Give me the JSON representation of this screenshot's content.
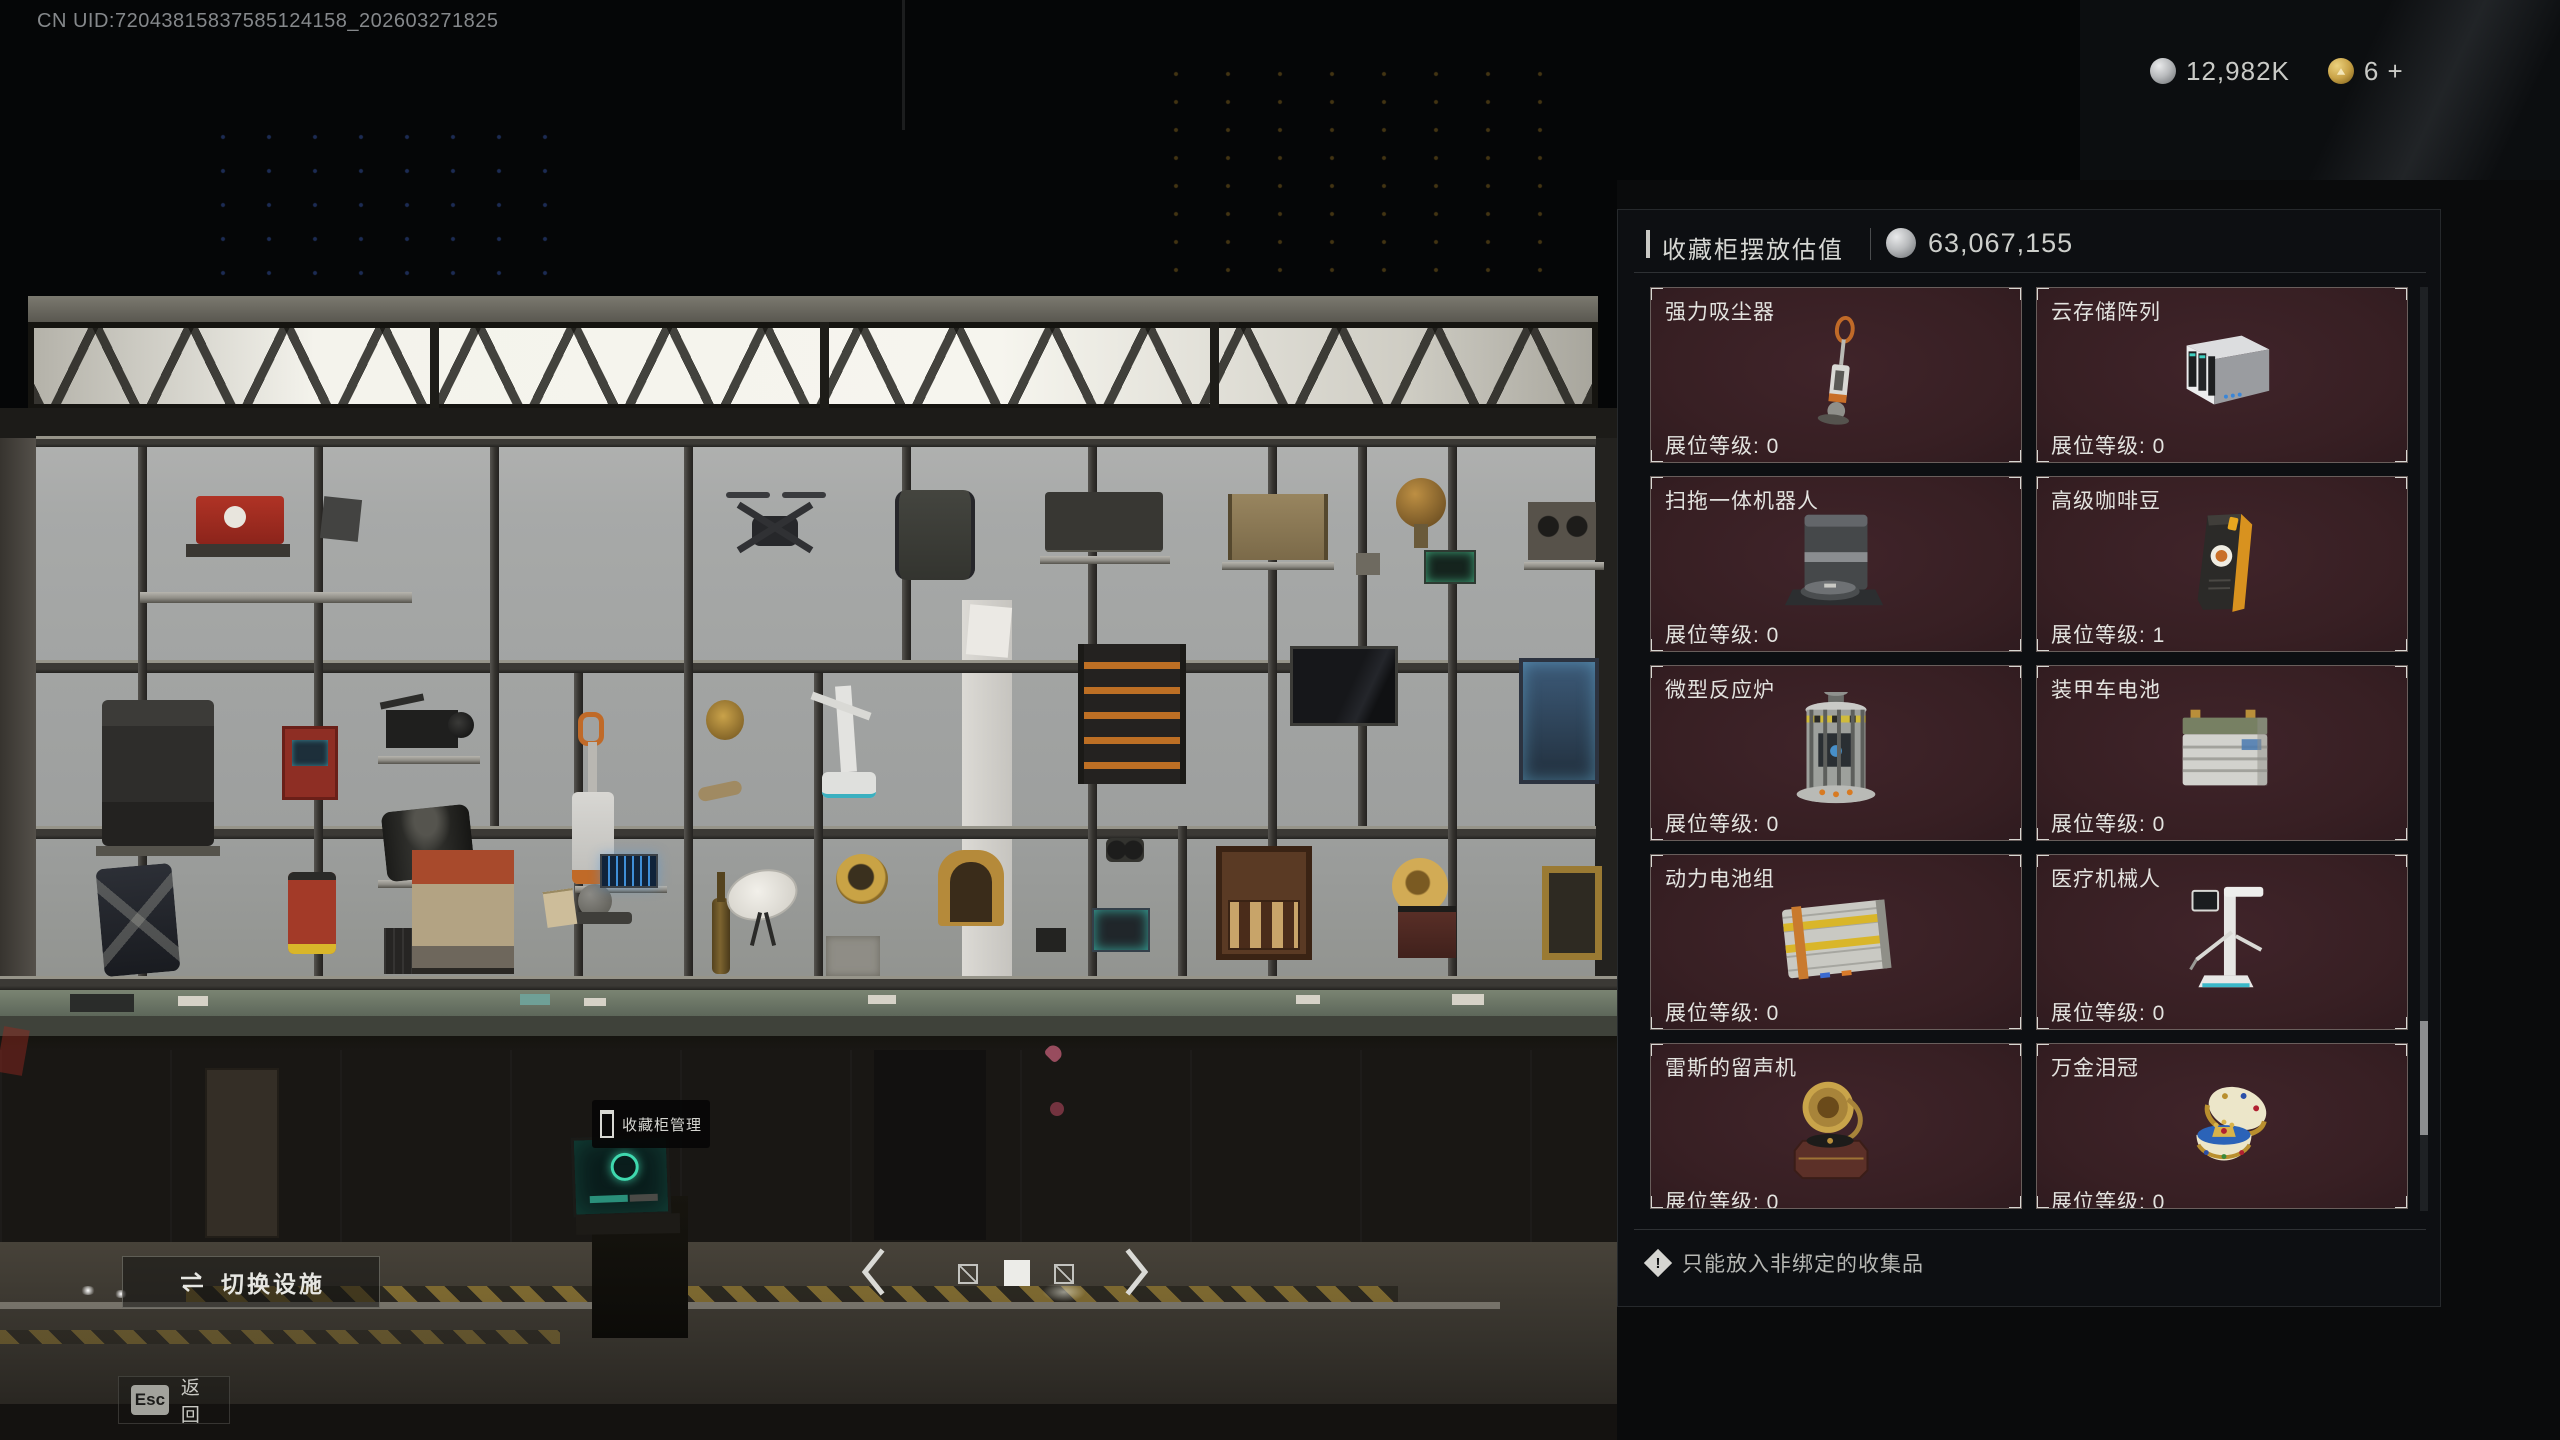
{
  "top_bar": {
    "uid": "CN UID:72043815837585124158_202603271825",
    "currencies": [
      {
        "icon": "silver-coin",
        "value": "12,982K"
      },
      {
        "icon": "gold-coin",
        "value": "6 +"
      }
    ]
  },
  "panel": {
    "title": "收藏柜摆放估值",
    "value_icon": "silver-coin",
    "value": "63,067,155",
    "level_label": "展位等级: ",
    "items": [
      {
        "name": "强力吸尘器",
        "level": "0",
        "art": "vacuum"
      },
      {
        "name": "云存储阵列",
        "level": "0",
        "art": "nas"
      },
      {
        "name": "扫拖一体机器人",
        "level": "0",
        "art": "robot-mop"
      },
      {
        "name": "高级咖啡豆",
        "level": "1",
        "art": "coffee-bag"
      },
      {
        "name": "微型反应炉",
        "level": "0",
        "art": "micro-reactor"
      },
      {
        "name": "装甲车电池",
        "level": "0",
        "art": "vehicle-battery"
      },
      {
        "name": "动力电池组",
        "level": "0",
        "art": "power-pack"
      },
      {
        "name": "医疗机械人",
        "level": "0",
        "art": "medical-robot"
      },
      {
        "name": "雷斯的留声机",
        "level": "0",
        "art": "gramophone"
      },
      {
        "name": "万金泪冠",
        "level": "0",
        "art": "jeweled-egg-crown"
      }
    ],
    "note": "只能放入非绑定的收集品"
  },
  "scene": {
    "terminal_label": "收藏柜管理"
  },
  "actions": {
    "switch_facility": "切换设施",
    "esc_key": "Esc",
    "back_label": "返回"
  },
  "pager": {
    "total_pages": 3,
    "active_page": 2
  },
  "colors": {
    "card_bg": "#3B2126",
    "panel_bg": "#0D1013",
    "gold": "#C9A348",
    "silver": "#B9BBBD",
    "hazard_yellow": "#B9952E"
  }
}
